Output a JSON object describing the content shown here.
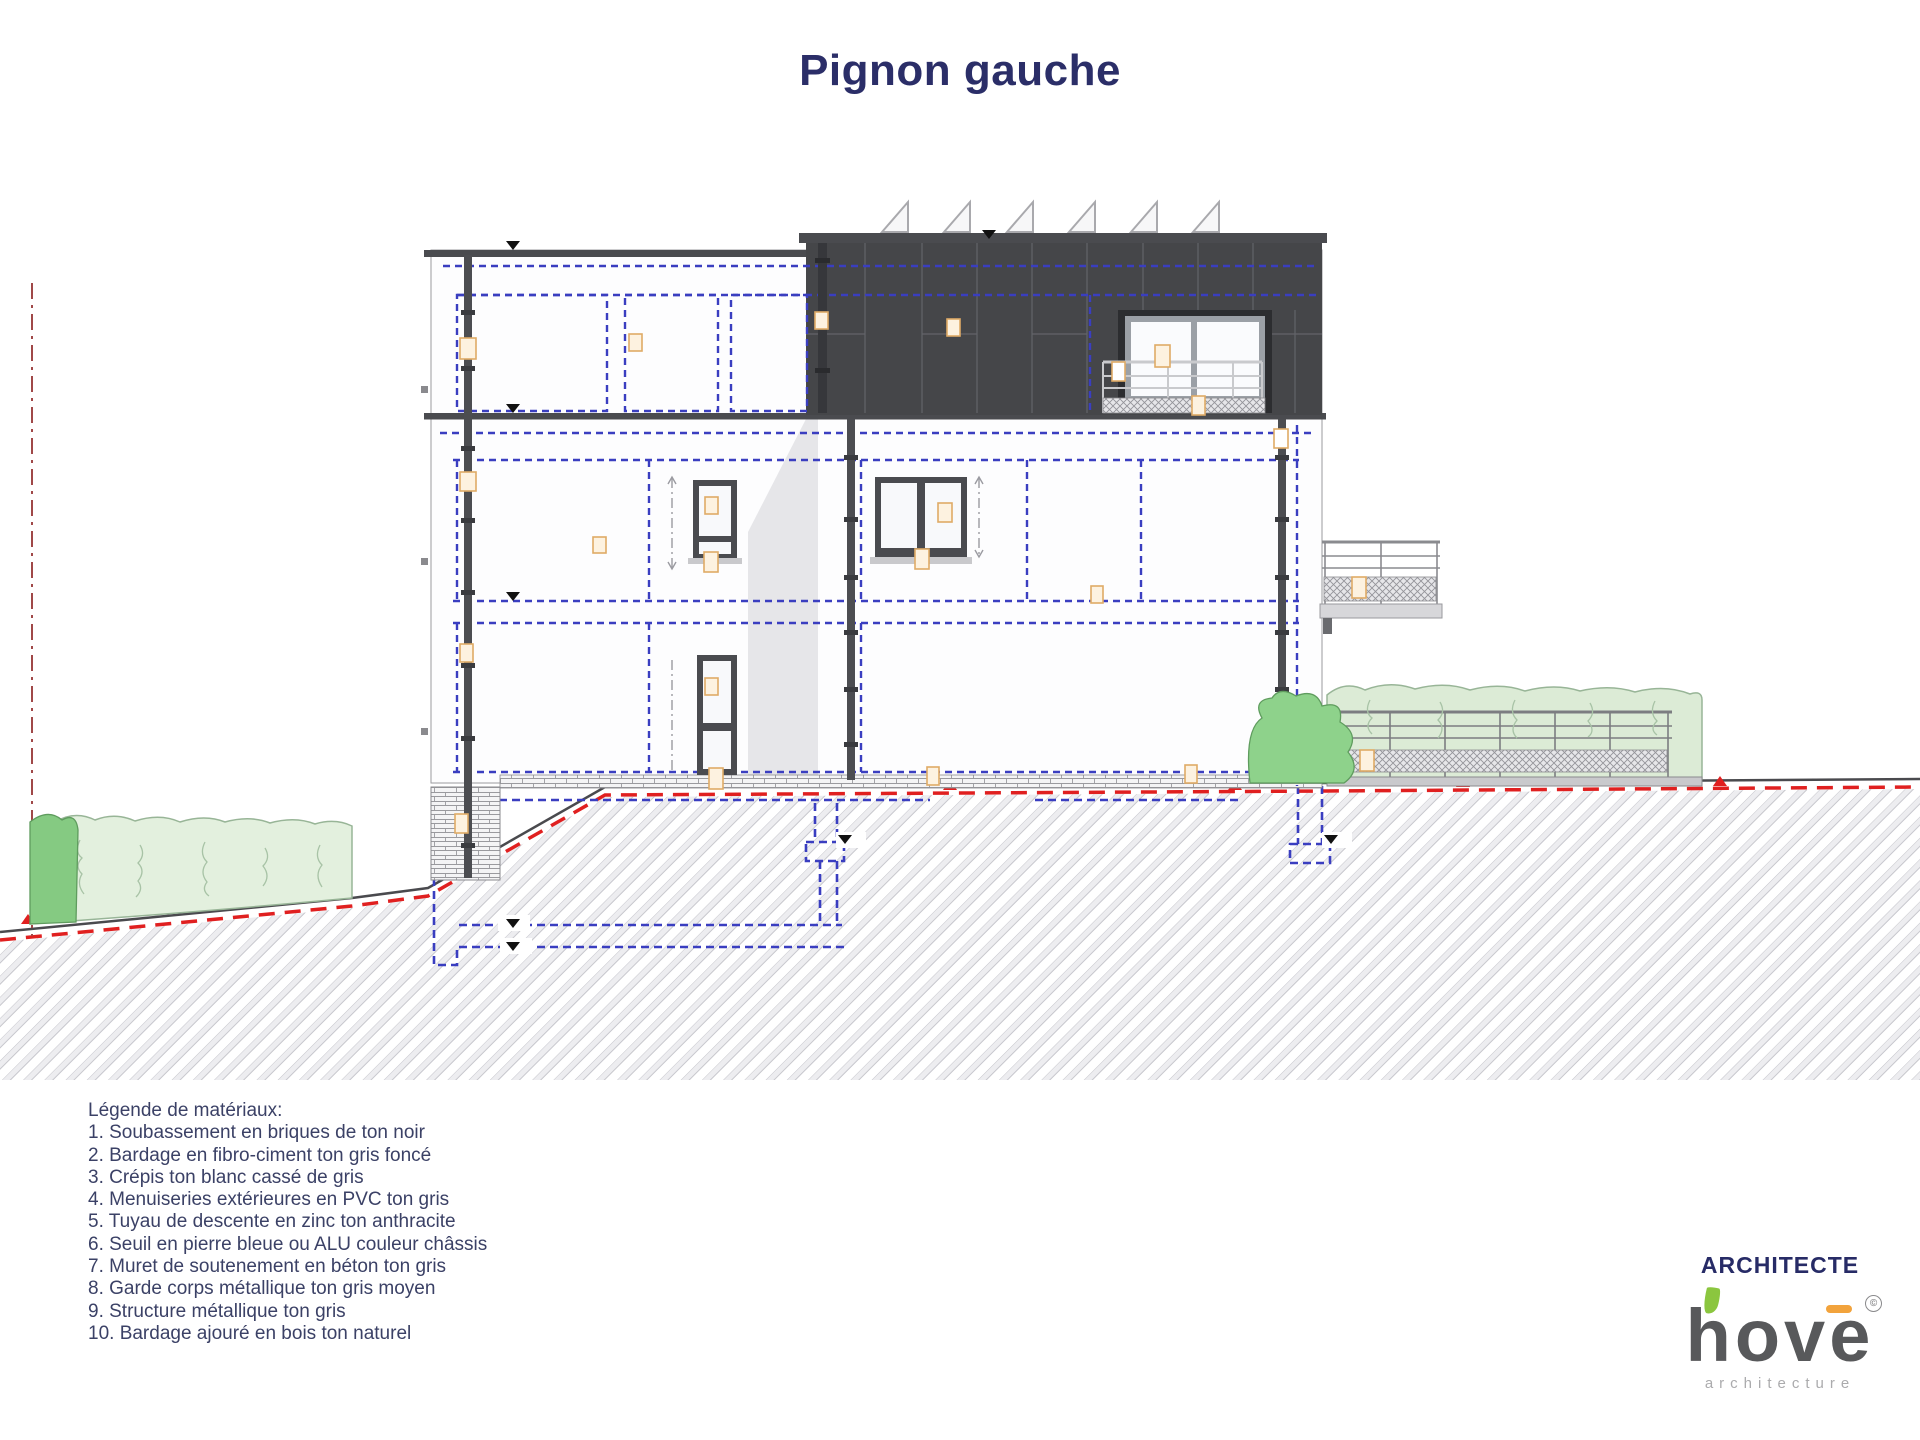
{
  "title": "Pignon gauche",
  "legend": {
    "header": "Légende de matériaux:",
    "items": [
      "1. Soubassement en briques de ton noir",
      "2. Bardage en fibro-ciment ton gris foncé",
      "3. Crépis ton blanc cassé de gris",
      "4. Menuiseries extérieures en PVC ton gris",
      "5. Tuyau de descente en zinc ton anthracite",
      "6. Seuil en pierre bleue ou ALU couleur châssis",
      "7. Muret de soutenement en béton ton gris",
      "8. Garde corps métallique ton gris moyen",
      "9. Structure métallique ton gris",
      "10. Bardage ajouré en bois ton naturel"
    ]
  },
  "branding": {
    "label": "ARCHITECTE",
    "logo_text": "hove",
    "logo_sub": "architecture",
    "copyright": "©"
  },
  "colors": {
    "title_navy": "#2b2e68",
    "legend_text": "#3b4166",
    "dark_cladding": "#454649",
    "frame_dark": "#4a4b4f",
    "dashed_blue": "#3a3ec0",
    "dashed_red": "#e02020",
    "property_line_red": "#a04848",
    "hedge_light": "#e0efda",
    "bush_green": "#85ca82",
    "marker_beige": "#fdf2e0",
    "logo_leaf_green": "#8bc63f",
    "logo_accent_orange": "#f2a33c"
  }
}
